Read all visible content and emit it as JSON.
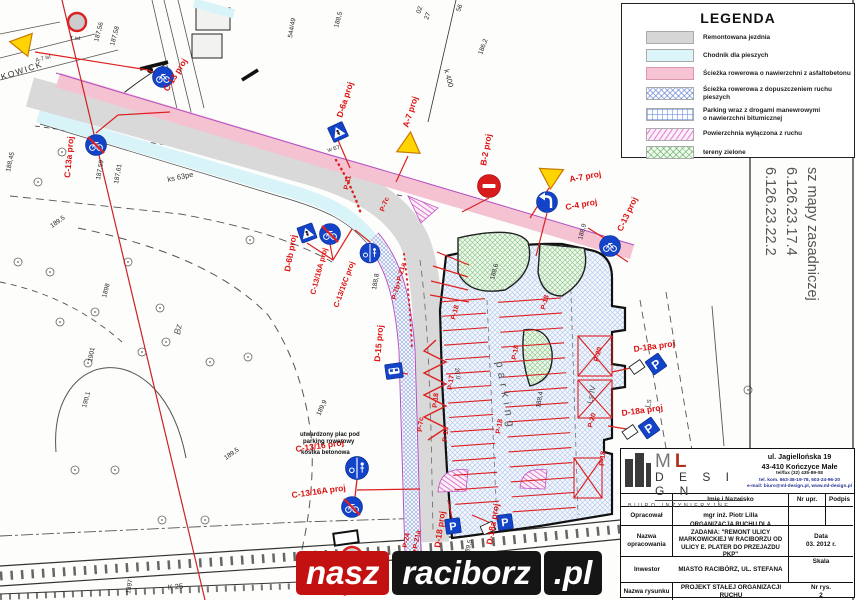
{
  "legend": {
    "title": "LEGENDA",
    "items": [
      {
        "label": "Remontowana jezdnia"
      },
      {
        "label": "Chodnik dla pieszych"
      },
      {
        "label": "Ścieżka rowerowa o nawierzchni z asfaltobetonu"
      },
      {
        "label": "Ścieżka rowerowa z dopuszczeniem ruchu pieszych"
      },
      {
        "label": "Parking wraz z drogami manewrowymi",
        "label2": "o nawierzchni bitumicznej"
      },
      {
        "label": "Powierzchnia wyłączona z ruchu"
      },
      {
        "label": "tereny zielone"
      }
    ]
  },
  "map": {
    "street_name": "KOWICK",
    "parking_word": "parking",
    "notes": {
      "l1": "utwardzony plac pod",
      "l2": "parking rowerowy",
      "l3": "kostka betonowa"
    },
    "signs": {
      "c13": "C-13 proj",
      "c13a": "C-13a proj",
      "d6a": "D-6a proj",
      "a7_mid": "A-7 proj",
      "b2": "B-2 proj",
      "a7_right": "A-7 proj",
      "c4": "C-4 proj",
      "c13_right": "C-13 proj",
      "d6b": "D-6b proj",
      "c1316a_curve": "C-13/16A proj",
      "c1316c_curve": "C-13/16C proj",
      "d15": "D-15 proj",
      "c1316_bottom": "C-13/16 proj",
      "c1316a_bottom": "C-13/16A proj",
      "d18": "D-18 proj",
      "d18a_bottom": "D-18a proj",
      "d18a_r1": "D-18a proj",
      "d18a_r2": "D-18a proj",
      "a7_ist": "A-7 ist",
      "t_ist": "T ist",
      "p_glyph": "P"
    },
    "markings": {
      "p11": "P-11",
      "p7c": "P-7c",
      "p17": "P-17",
      "p18": "P-18",
      "p20": "P-20",
      "p24": "P-24",
      "p7b_p21a": "P-7b+P-21a"
    },
    "labels": {
      "ks63pe": "ks 63pe",
      "k400": "k 400",
      "k25": "K 25",
      "w67": "w 67",
      "bz": "Bz",
      "ls_iv": "Ls IV",
      "ls": "Ls",
      "g3": "G-3",
      "dim": "20.0"
    },
    "elevations": [
      "187,56",
      "187,58",
      "544/49",
      "188,5",
      "186,2",
      "188,45",
      "187,59",
      "187,61",
      "189,5",
      "190,1",
      "1898",
      "1901",
      "189,9",
      "188,8",
      "188,9",
      "188,6",
      "188,4",
      "189,5",
      "1892",
      "1897",
      "02",
      "27",
      "56",
      "189,5"
    ],
    "side_note": {
      "l1": "sz mapy zasadniczej",
      "l2": "6.126.23.17.4",
      "l3": "6.126.23.22.2"
    }
  },
  "title_block": {
    "company": {
      "name_m": "M",
      "name_l": "L",
      "name_design": "D E S I G N",
      "subtitle": "BIURO INŻYNIERYJNE",
      "address1": "ul. Jagiellońska 19",
      "address2": "43-410 Kończyce Małe",
      "phone": "tel/fax (32) 435-89-08",
      "mobile": "tel. kom. 663-38-19-78, 603-24-96-20",
      "email": "e-mail: biuro@ml-design.pl, www.ml-design.pl"
    },
    "header": {
      "col_name": "Imię i Nazwisko",
      "col_nr": "Nr upr.",
      "col_sign": "Podpis"
    },
    "rows": {
      "opracowal_label": "Opracował",
      "opracowal_value": "mgr inż. Piotr Lilla",
      "nazwa_label": "Nazwa opracowania",
      "nazwa_value": "ORGANIZACJA RUCHU DLA ZADANIA: \"REMONT ULICY MARKOWICKIEJ W RACIBORZU OD ULICY E. PLATER DO PRZEJAZDU PKP\"",
      "data_label": "Data",
      "data_value": "03. 2012 r.",
      "inwestor_label": "Inwestor",
      "inwestor_value": "MIASTO RACIBÓRZ, UL. STEFANA",
      "skala_label": "Skala",
      "rysunek_label": "Nazwa rysunku",
      "rysunek_value": "PROJEKT STAŁEJ ORGANIZACJI RUCHU",
      "nr_label": "Nr rys.",
      "nr_value": "2"
    }
  },
  "watermark": {
    "nasz": "nasz",
    "raciborz": "raciborz",
    "pl": ".pl"
  }
}
